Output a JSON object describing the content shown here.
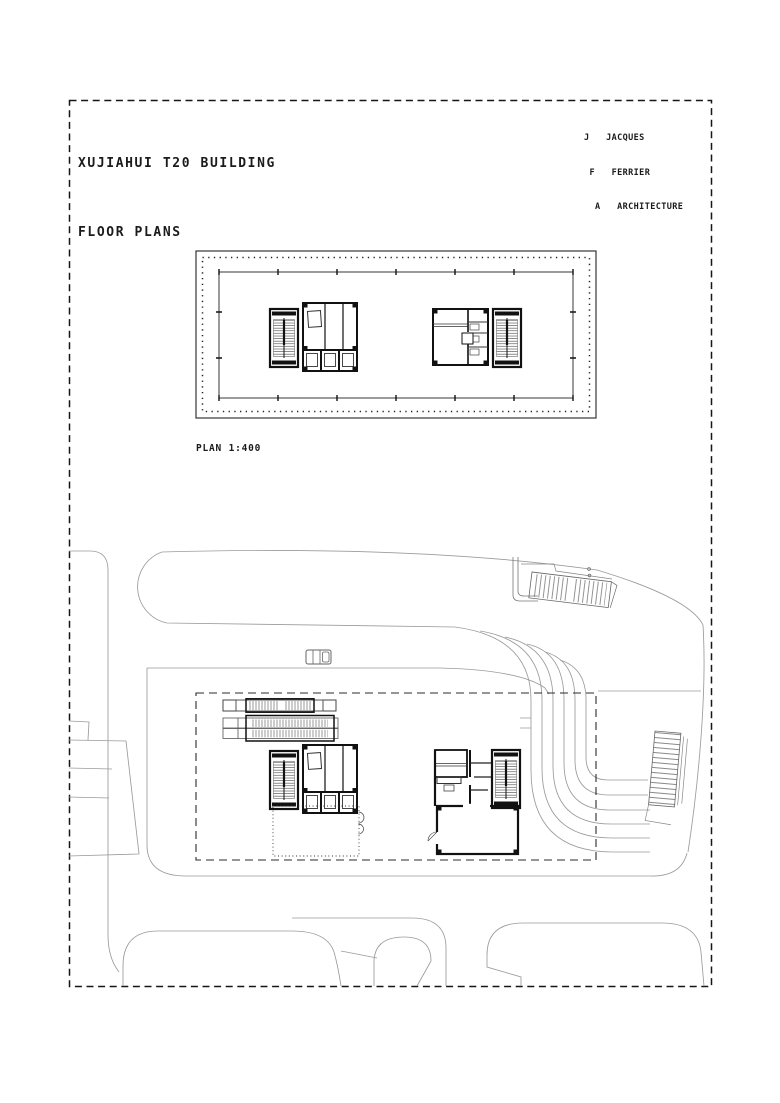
{
  "sheet": {
    "title_line1": "XUJIAHUI T20 BUILDING",
    "title_line2": "FLOOR PLANS",
    "plan_label": "PLAN 1:400",
    "logo": {
      "line1": "J   JACQUES",
      "line2": " F   FERRIER",
      "line3": "  A   ARCHITECTURE"
    },
    "colors": {
      "ink": "#1b1b1b",
      "wall": "#111111",
      "road": "#9b9b9b",
      "paper": "#ffffff"
    }
  }
}
